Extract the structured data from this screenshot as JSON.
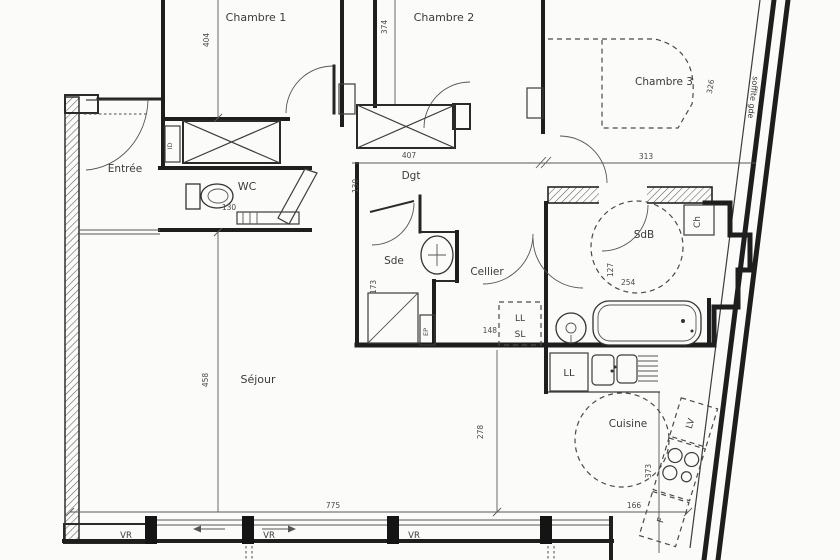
{
  "rooms": {
    "entree": "Entrée",
    "chambre1": "Chambre 1",
    "chambre2": "Chambre 2",
    "chambre3": "Chambre 3",
    "wc": "WC",
    "dgt": "Dgt",
    "sde": "Sde",
    "cellier": "Cellier",
    "sdb": "SdB",
    "sejour": "Séjour",
    "cuisine": "Cuisine"
  },
  "dimensions_cm": {
    "chambre1_depth": "404",
    "chambre2_depth": "374",
    "chambre3_depth": "326",
    "dgt_length": "407",
    "chambre3_width": "313",
    "dgt_width": "130",
    "wc_width": "130",
    "sde_depth": "173",
    "cellier_width": "148",
    "sdb_depth": "127",
    "sdb_width": "254",
    "sejour_depth": "458",
    "sejour_mid_depth": "278",
    "cuisine_depth": "373",
    "cuisine_width": "166",
    "sejour_width": "775"
  },
  "equipment": {
    "entry_duct": "ID",
    "washer_label": "LL",
    "dryer_label": "SL",
    "rainwater_pipe": "EP",
    "boiler": "Ch",
    "kitchen_washer": "LL",
    "dishwasher": "LV",
    "fridge": "F"
  },
  "windows": {
    "shutter1": "VR",
    "shutter2": "VR",
    "shutter3": "VR"
  },
  "annotations": {
    "soffit": "soffite gde"
  }
}
